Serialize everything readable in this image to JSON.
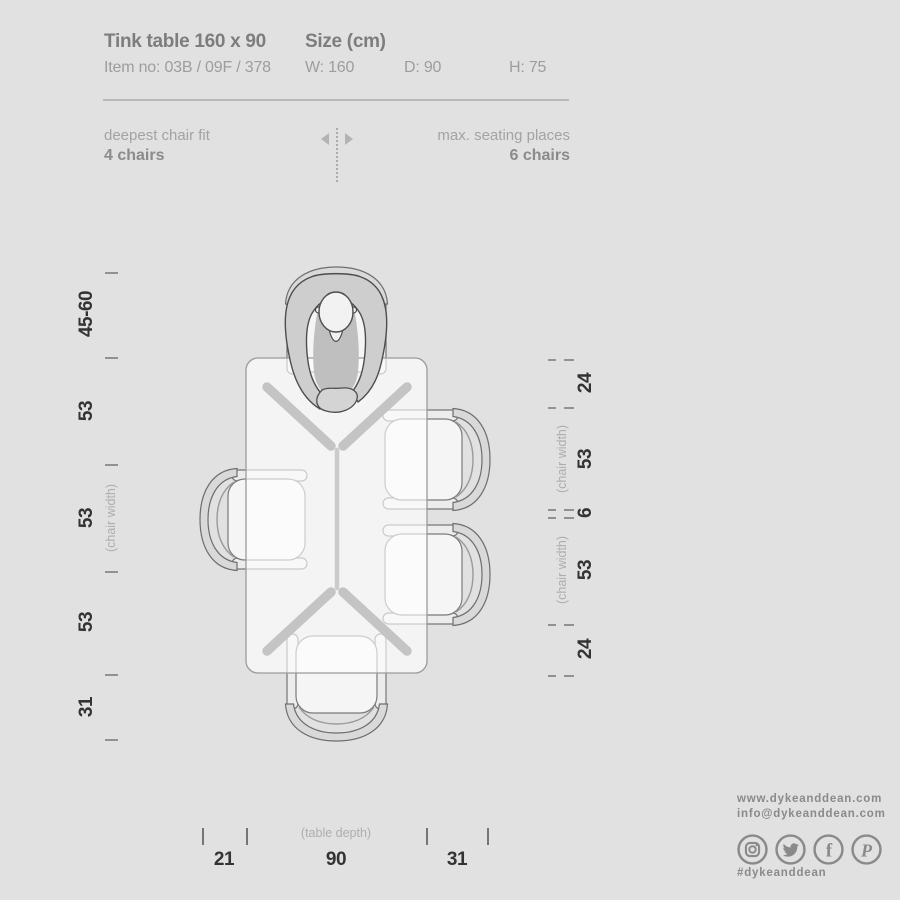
{
  "header": {
    "title": "Tink table 160 x 90",
    "item_no": "Item no: 03B / 09F / 378",
    "size_label": "Size (cm)",
    "size_w": "W: 160",
    "size_d": "D: 90",
    "size_h": "H: 75"
  },
  "seating": {
    "deepest_label": "deepest chair fit",
    "deepest_value": "4 chairs",
    "max_label": "max. seating places",
    "max_value": "6 chairs"
  },
  "dimensions": {
    "left": [
      "45-60",
      "53",
      "53",
      "53",
      "31"
    ],
    "right": [
      "24",
      "53",
      "6",
      "53",
      "24"
    ],
    "bottom": [
      "21",
      "90",
      "31"
    ],
    "chair_width_note": "(chair width)",
    "table_depth_note": "(table depth)"
  },
  "footer": {
    "website": "www.dykeanddean.com",
    "email": "info@dykeanddean.com",
    "hashtag": "#dykeanddean",
    "social": [
      "instagram",
      "twitter",
      "facebook",
      "pinterest"
    ]
  },
  "colors": {
    "background": "#e1e1e1",
    "text_dark": "#333333",
    "text_gray": "#8a8a8a",
    "line": "#9b9b9b",
    "trestle": "#c4c4c4"
  }
}
